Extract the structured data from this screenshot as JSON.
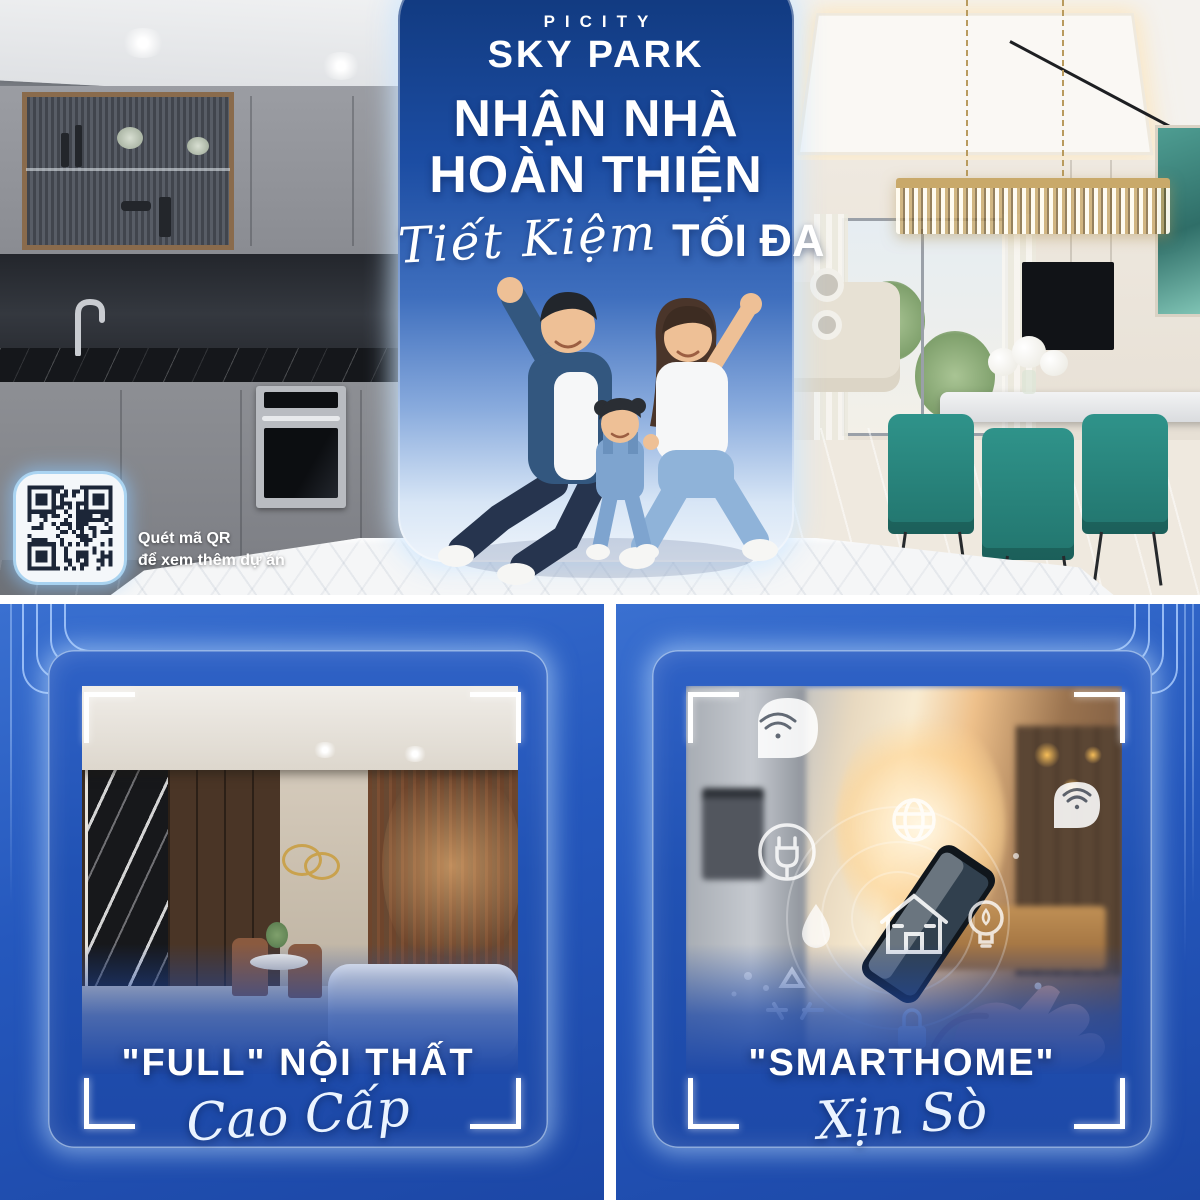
{
  "banner": {
    "brand_top": "PICITY",
    "brand_name": "SKY PARK",
    "headline1": "NHẬN NHÀ",
    "headline2": "HOÀN THIỆN",
    "tagline_script": "Tiết Kiệm",
    "tagline_strong": "TỐI ĐA",
    "qr_caption1": "Quét mã QR",
    "qr_caption2": "để xem thêm dự án"
  },
  "cards": {
    "interior": {
      "title": "\"FULL\" NỘI THẤT",
      "subtitle": "Cao Cấp"
    },
    "smarthome": {
      "title": "\"SMARTHOME\"",
      "subtitle": "Xịn Sò"
    }
  },
  "icons": {
    "smarthome_overlay": [
      "wifi",
      "plug",
      "globe",
      "house",
      "droplet",
      "bulb",
      "recycle",
      "lock"
    ]
  },
  "colors": {
    "brand_blue": "#1c4da3",
    "panel_blue": "#2558bd",
    "card_blue": "#2152b4",
    "accent_light": "#cfe3ff",
    "text_white": "#ffffff"
  }
}
